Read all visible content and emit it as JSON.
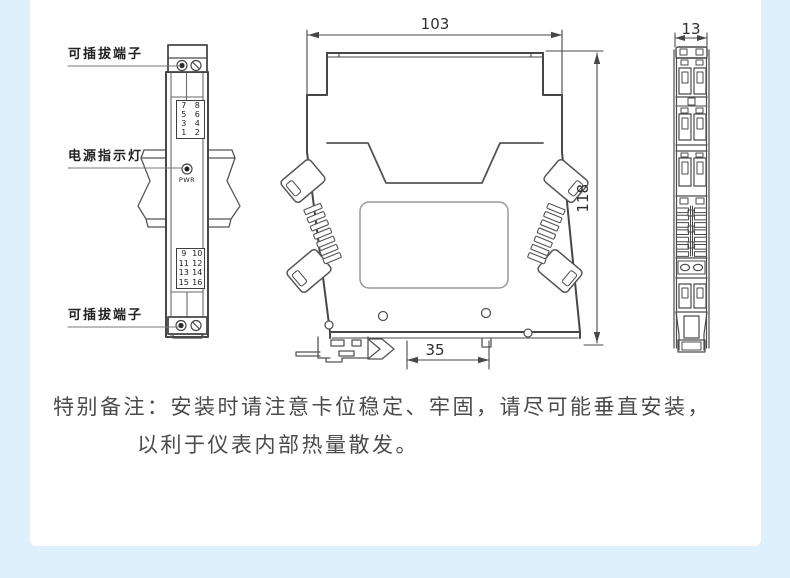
{
  "colors": {
    "page_bg": "#def0fb",
    "card_bg": "#ffffff",
    "line": "#474747",
    "note_text": "#4b4b4b"
  },
  "front_view": {
    "label_terminal_top": "可插拔端子",
    "label_power_led": "电源指示灯",
    "label_terminal_bottom": "可插拔端子",
    "pwr_label": "PWR",
    "top_terminals": {
      "rows": [
        {
          "l": "7",
          "r": "8"
        },
        {
          "l": "5",
          "r": "6"
        },
        {
          "l": "3",
          "r": "4"
        },
        {
          "l": "1",
          "r": "2"
        }
      ]
    },
    "bottom_terminals": {
      "rows": [
        {
          "l": "9",
          "r": "10"
        },
        {
          "l": "11",
          "r": "12"
        },
        {
          "l": "13",
          "r": "14"
        },
        {
          "l": "15",
          "r": "16"
        }
      ]
    }
  },
  "dimensions": {
    "body_width_mm": "103",
    "body_height_mm": "118",
    "rail_width_mm": "35",
    "body_depth_mm": "13"
  },
  "note": {
    "line1": "特别备注：安装时请注意卡位稳定、牢固，请尽可能垂直安装，",
    "line2": "以利于仪表内部热量散发。"
  }
}
